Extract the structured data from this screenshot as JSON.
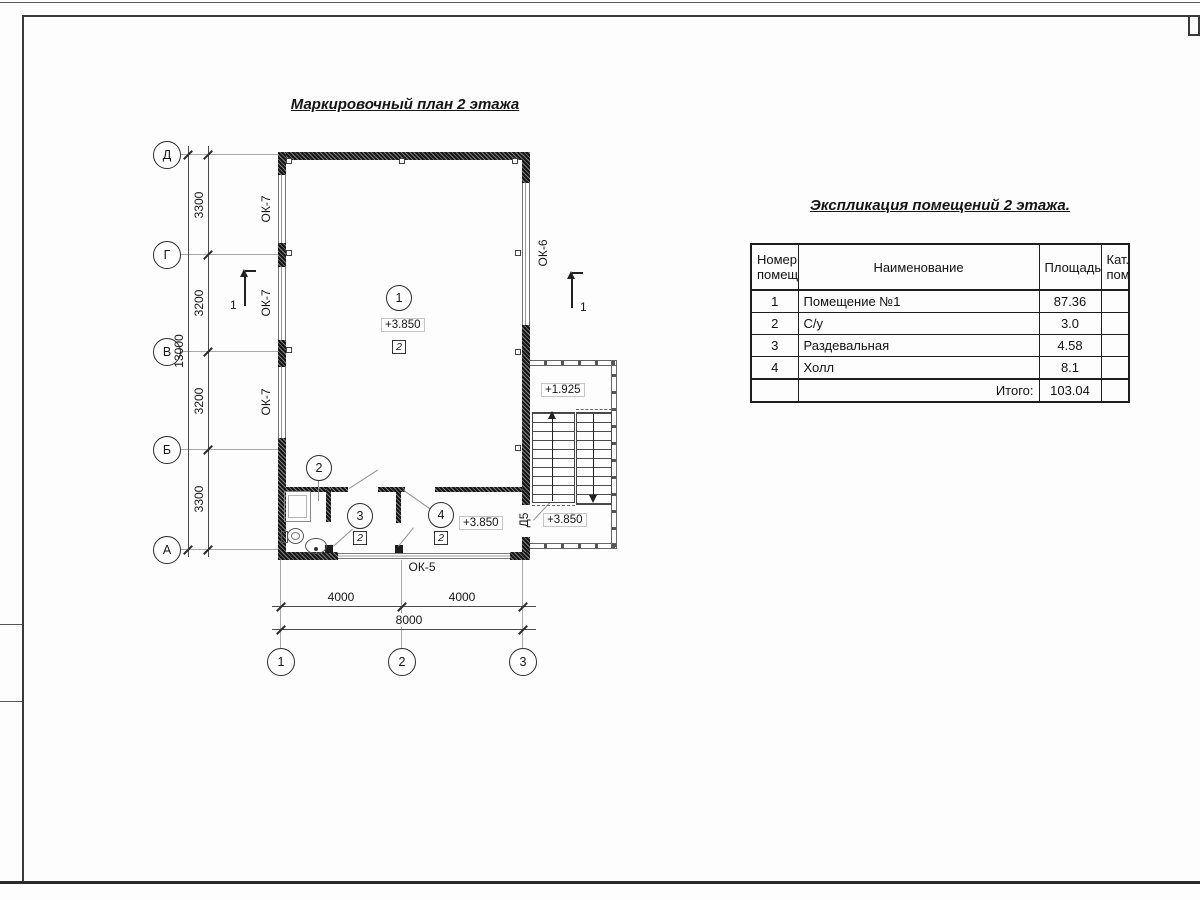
{
  "titles": {
    "plan": "Маркировочный план 2 этажа",
    "table": "Экспликация помещений 2 этажа."
  },
  "axes": {
    "h": [
      "Д",
      "Г",
      "В",
      "Б",
      "А"
    ],
    "v": [
      "1",
      "2",
      "3"
    ]
  },
  "dims": {
    "left_chain": [
      "3300",
      "3200",
      "3200",
      "3300"
    ],
    "left_total": "13000",
    "bottom_chain": [
      "4000",
      "4000"
    ],
    "bottom_total": "8000"
  },
  "openings": {
    "window_left": "ОК-7",
    "window_right": "ОК-6",
    "window_bottom": "ОК-5",
    "door": "Д5"
  },
  "section_mark": "1",
  "rooms": {
    "r1": {
      "num": "1",
      "elev": "+3.850",
      "floor": "2"
    },
    "r2": {
      "num": "2"
    },
    "r3": {
      "num": "3",
      "floor": "2"
    },
    "r4": {
      "num": "4",
      "floor": "2",
      "elev": "+3.850"
    }
  },
  "stairs": {
    "upper_elev": "+1.925",
    "lower_elev": "+3.850"
  },
  "table": {
    "headers": {
      "num1": "Номер",
      "num2": "помещ.",
      "name": "Наименование",
      "area": "Площадь",
      "cat1": "Кат.",
      "cat2": "пом."
    },
    "rows": [
      {
        "num": "1",
        "name": "Помещение №1",
        "area": "87.36",
        "cat": ""
      },
      {
        "num": "2",
        "name": "С/у",
        "area": "3.0",
        "cat": ""
      },
      {
        "num": "3",
        "name": "Раздевальная",
        "area": "4.58",
        "cat": ""
      },
      {
        "num": "4",
        "name": "Холл",
        "area": "8.1",
        "cat": ""
      }
    ],
    "total_label": "Итого:",
    "total_value": "103.04"
  }
}
